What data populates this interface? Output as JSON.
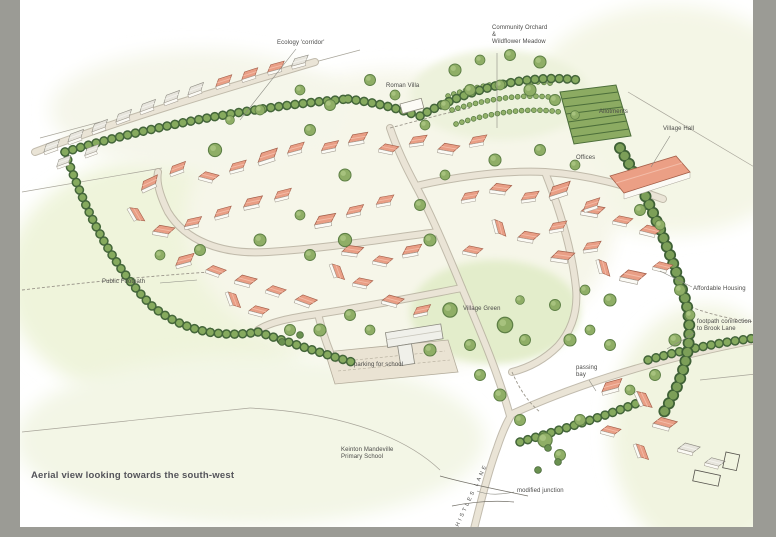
{
  "caption": "Aerial view looking towards the south-west",
  "labels": {
    "ecology_corridor": "Ecology 'corridor'",
    "community_orchard": "Community Orchard\n&\nWildflower Meadow",
    "roman_villa": "Roman Villa",
    "allotments": "Allotments",
    "village_hall": "Village Hall",
    "offices": "Offices",
    "public_footpath": "Public Footpath",
    "affordable_housing": "Affordable Housing",
    "footpath_connection": "footpath connection\nto Brook Lane",
    "village_green": "Village Green",
    "parking_for_school": "parking for school",
    "passing_bay": "passing\nbay",
    "school": "Keinton Mandeville\nPrimary School",
    "modified_junction": "modified junction",
    "road_name": "CHISTLES LANE"
  },
  "colors": {
    "frame": "#9b9b95",
    "canvas": "#ffffff",
    "field_wash": "#f1f5e0",
    "village_green": "#e3edcb",
    "roof_new": "#e99e85",
    "roof_existing": "#e4e2da",
    "tree": "#8fae66",
    "hedge_dark": "#4e7340",
    "road": "#eae4d6",
    "label_text": "#4a4a48",
    "caption_text": "#54545a"
  }
}
